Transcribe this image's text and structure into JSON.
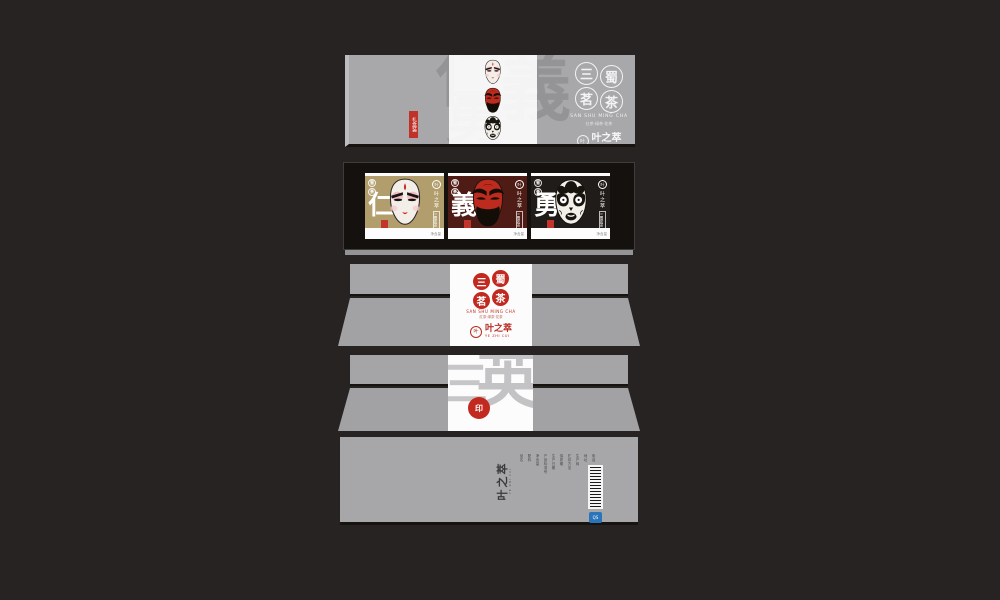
{
  "colors": {
    "background": "#272322",
    "box_gray": "#a8a8aa",
    "panel_white": "#fcfcfc",
    "seal_red": "#c2291f",
    "card_gold": "#b29d6c",
    "card_maroon": "#4e1b15",
    "card_black": "#201c19",
    "frame_dark": "#14110e"
  },
  "brand": {
    "name": "叶之萃",
    "pinyin": "YE ZHI CUI",
    "icon_char": "叶"
  },
  "product": {
    "name_chars": [
      "三",
      "蜀",
      "茗",
      "茶"
    ],
    "pinyin": "SAN SHU MING CHA",
    "categories": "红茶·绿茶·花茶",
    "mini_seals": [
      "蜀",
      "茶"
    ]
  },
  "lid": {
    "watermark": [
      "仁",
      "義",
      "勇"
    ],
    "ribbon": "礼盒装"
  },
  "cards": [
    {
      "virtue": "仁",
      "mask": "liubei",
      "side_label": "三蜀茗茶",
      "net": "净含量"
    },
    {
      "virtue": "義",
      "mask": "guanyu",
      "side_label": "三蜀茗茶",
      "net": "净含量"
    },
    {
      "virtue": "勇",
      "mask": "zhangfei",
      "side_label": "三蜀茗茶",
      "net": "净含量"
    }
  ],
  "back": {
    "watermark": [
      "三",
      "英"
    ],
    "seal_char": "印"
  },
  "bottom": {
    "info_labels": [
      "品名",
      "配料",
      "净含量",
      "产品标准号",
      "生产日期",
      "保质期",
      "贮存方法",
      "生产商",
      "地址",
      "电话"
    ],
    "qs_label": "QS"
  }
}
